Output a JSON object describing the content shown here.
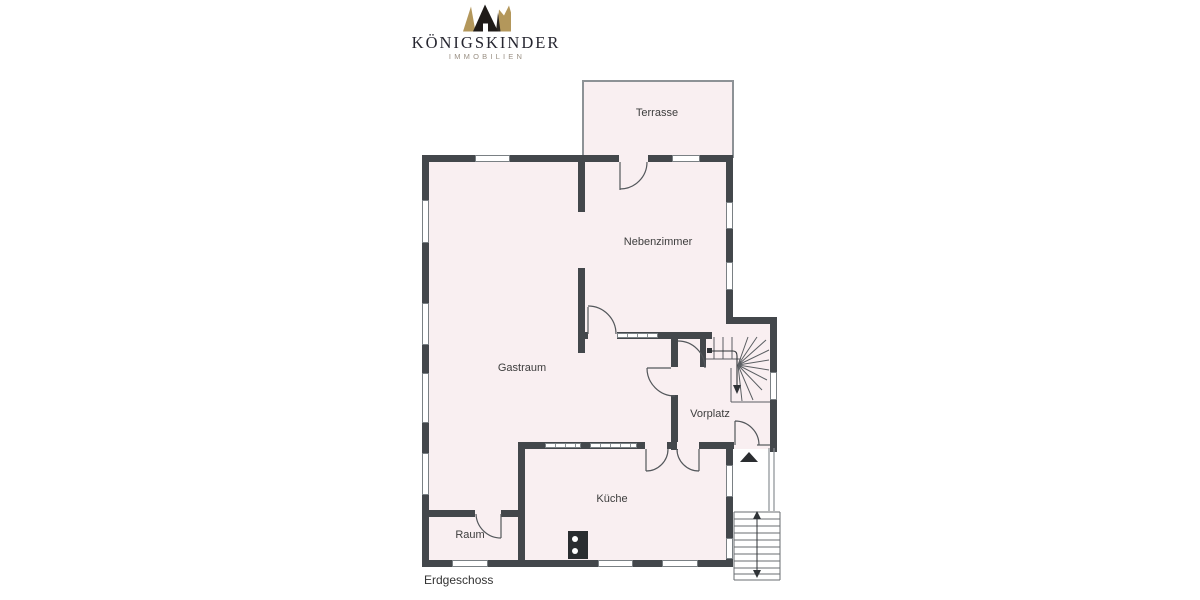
{
  "logo": {
    "brand": "KÖNIGSKINDER",
    "tagline": "IMMOBILIEN",
    "colors": {
      "brand_text": "#262630",
      "tagline_text": "#9a9084",
      "crown_gold": "#b3975b",
      "crown_black": "#1f1b18"
    }
  },
  "floor_plan": {
    "title": "Erdgeschoss",
    "rooms": [
      {
        "id": "terrasse",
        "label": "Terrasse"
      },
      {
        "id": "nebenzimmer",
        "label": "Nebenzimmer"
      },
      {
        "id": "gastraum",
        "label": "Gastraum"
      },
      {
        "id": "vorplatz",
        "label": "Vorplatz"
      },
      {
        "id": "kueche",
        "label": "Küche"
      },
      {
        "id": "raum",
        "label": "Raum"
      }
    ],
    "colors": {
      "wall": "#43474b",
      "floor": "#f9eff1",
      "line": "#53575b",
      "terrace_border": "#8d9296"
    },
    "symbols": {
      "entrance_arrow": "black triangle pointing up at entry door",
      "winder_staircase": "quarter-turn winder stair with walking line",
      "exterior_staircase": "straight entry stair with direction arrows",
      "chimney": "black block with two white flue circles"
    }
  }
}
